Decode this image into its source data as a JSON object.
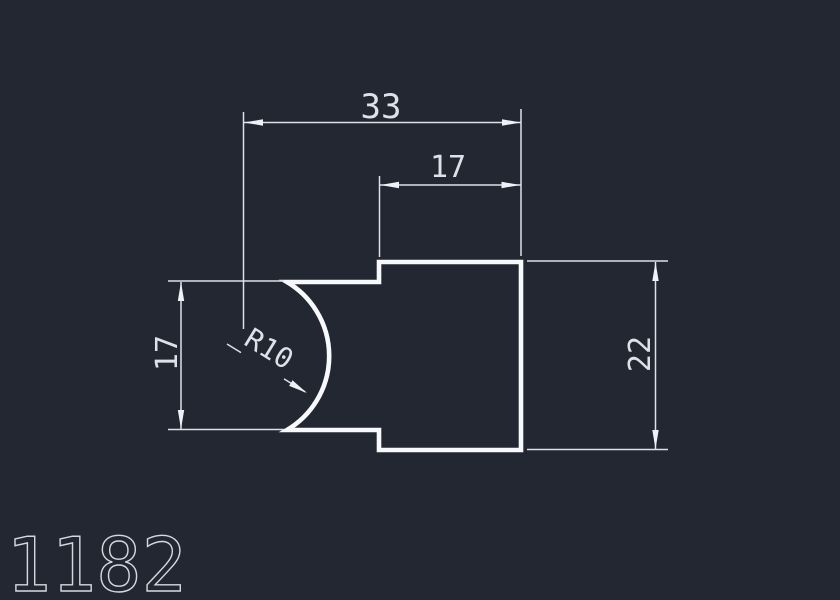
{
  "drawing": {
    "number": "1182",
    "background_color": "#222732",
    "outline_color": "#f7f9fc",
    "dimension_color": "#dde2e9",
    "dimensions": {
      "total_width": "33",
      "upper_width": "17",
      "left_height": "17",
      "right_height": "22",
      "groove_radius": "R10"
    }
  }
}
